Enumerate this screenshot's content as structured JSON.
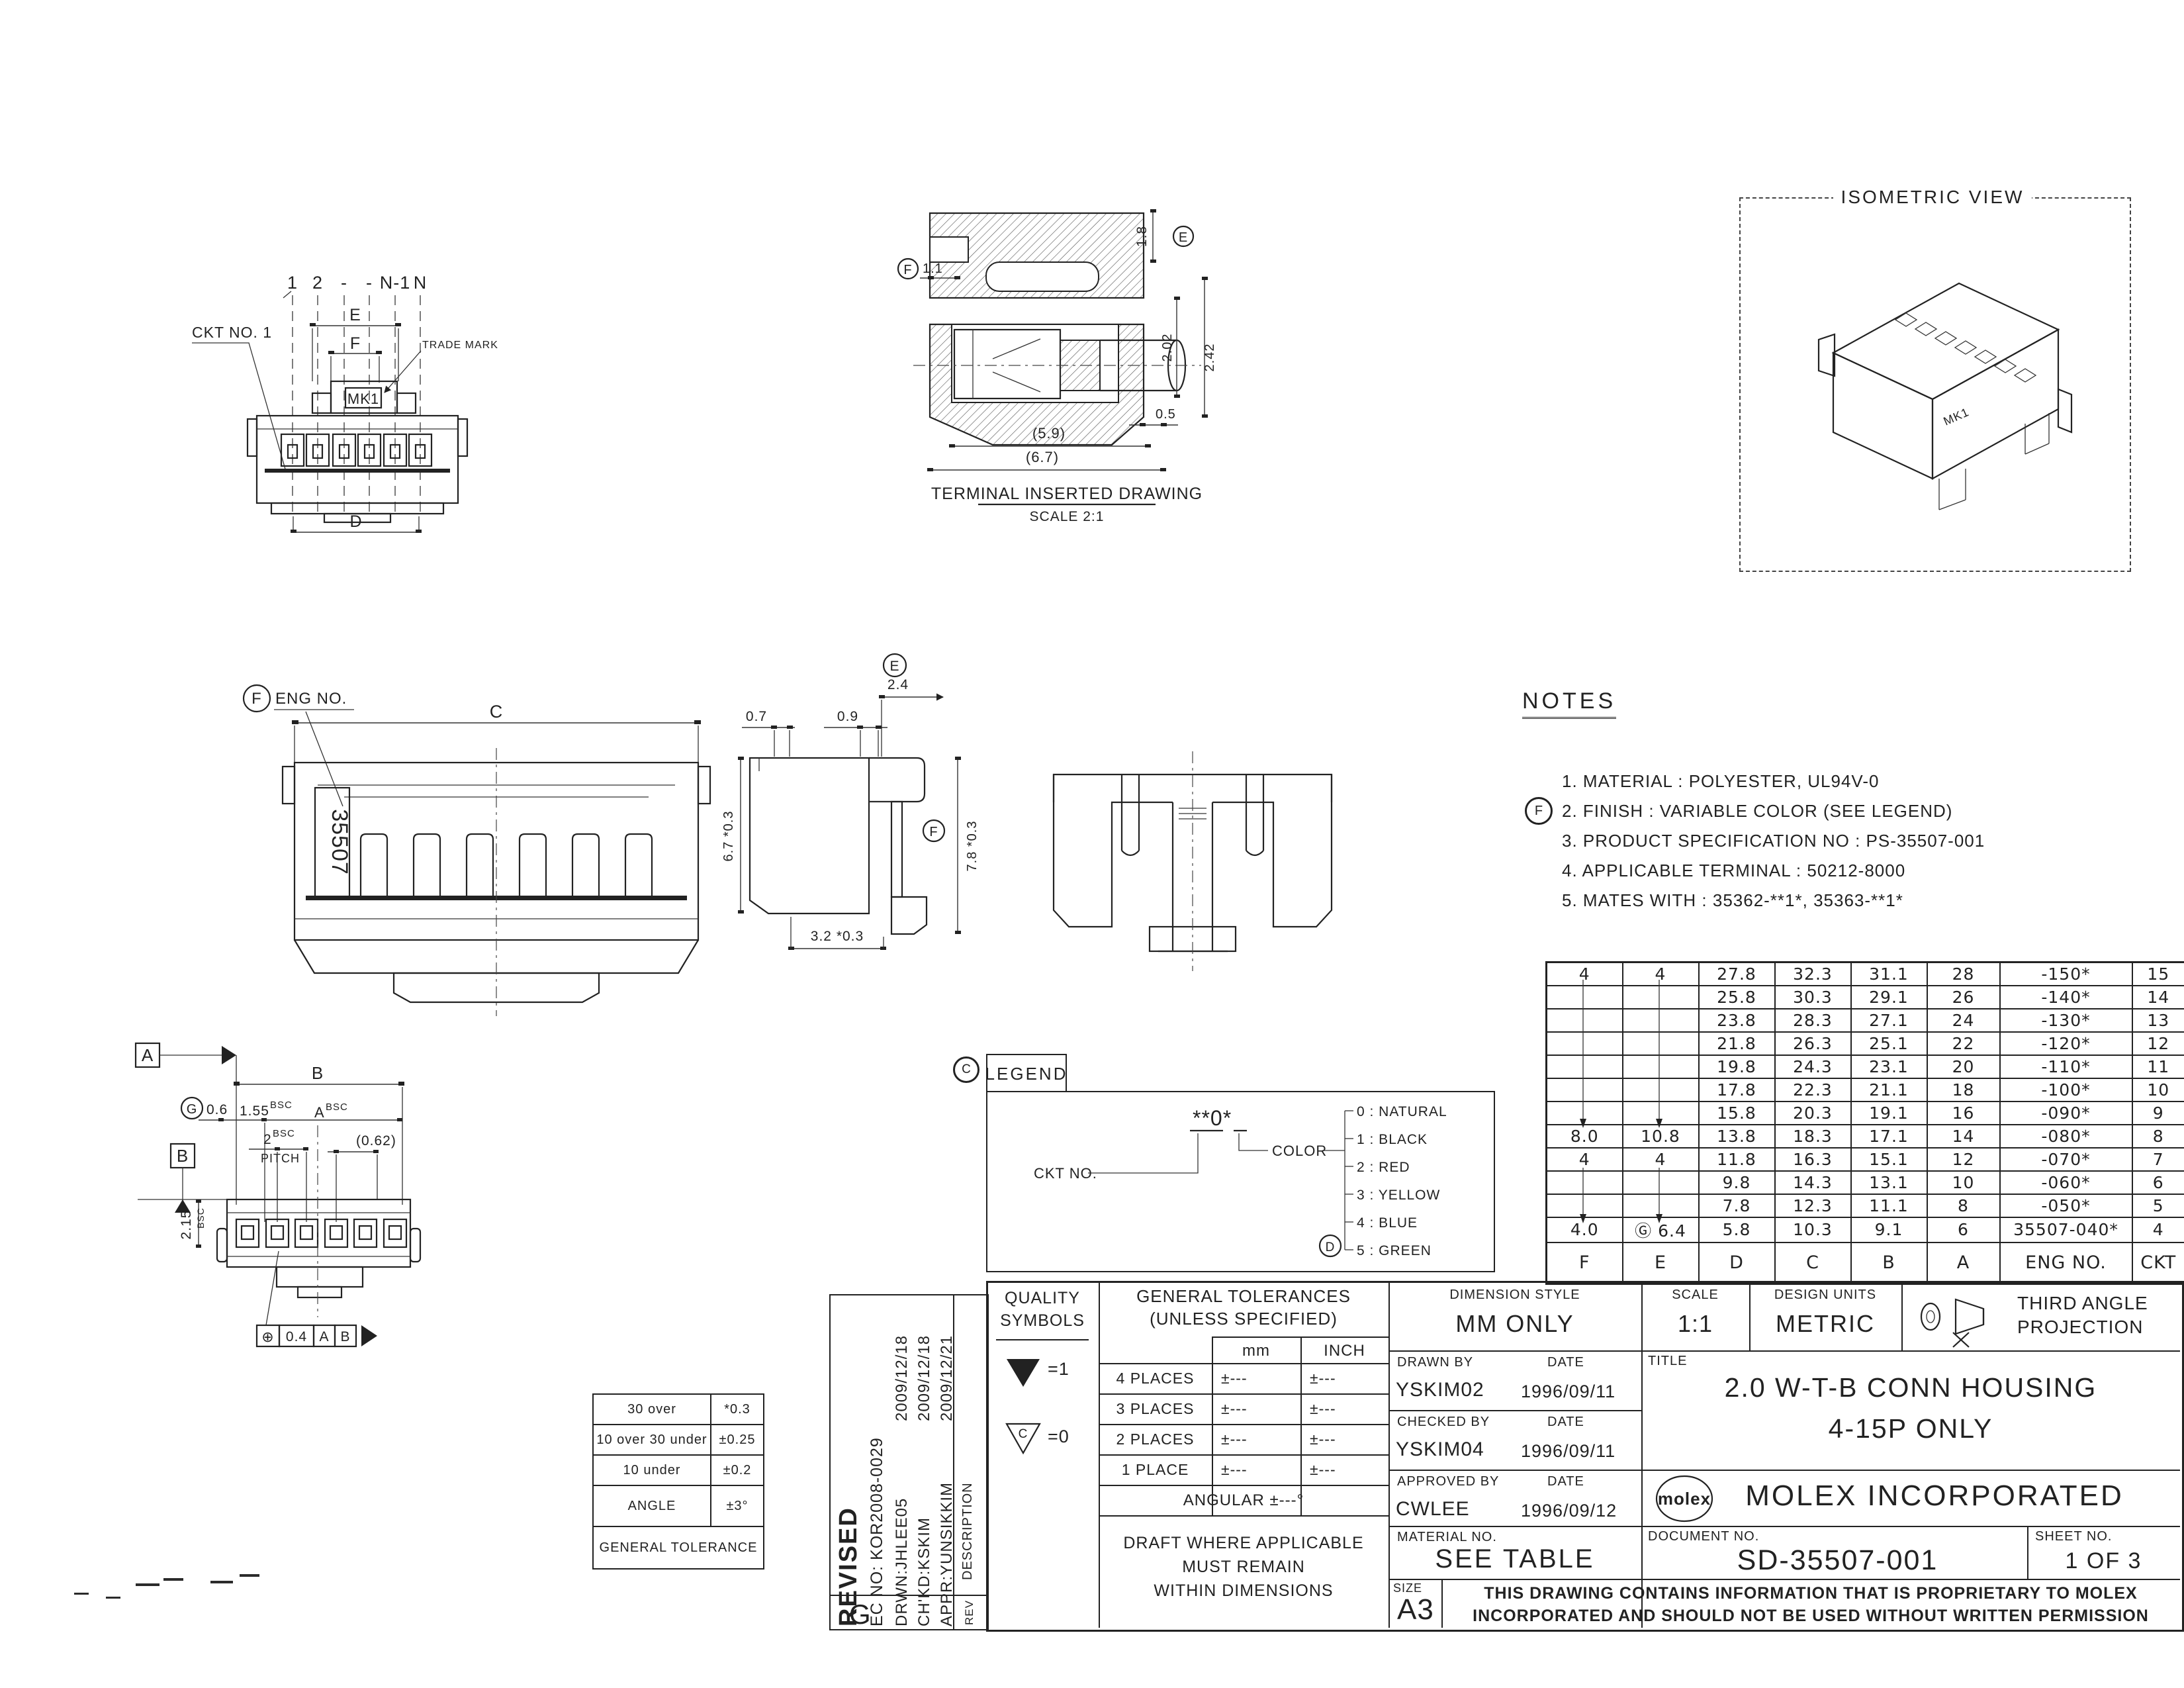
{
  "front_view": {
    "ckt_no": "CKT NO. 1",
    "circuit_labels": [
      "1",
      "2",
      "-",
      "-",
      "N-1",
      "N"
    ],
    "dim_e": "E",
    "dim_f": "F",
    "dim_d": "D",
    "trade_mark": "TRADE MARK",
    "mk1": "MK1"
  },
  "terminal_view": {
    "dim_18": "1.8",
    "dim_11": "1.1",
    "dim_202": "2.02",
    "dim_242": "2.42",
    "dim_05": "0.5",
    "dim_59": "(5.9)",
    "dim_67": "(6.7)",
    "balloon_e": "E",
    "balloon_f": "F",
    "caption": "TERMINAL INSERTED DRAWING",
    "scale": "SCALE 2:1"
  },
  "iso_view": {
    "title": "ISOMETRIC VIEW",
    "mk1": "MK1"
  },
  "rear_view": {
    "balloon_f": "F",
    "eng_no": "ENG NO.",
    "dim_c": "C",
    "part_no": "35507"
  },
  "side_view": {
    "balloon_e": "E",
    "balloon_f": "F",
    "dim_24": "2.4",
    "dim_07": "0.7",
    "dim_09": "0.9",
    "dim_67": "6.7 *0.3",
    "dim_78": "7.8 *0.3",
    "dim_32": "3.2 *0.3"
  },
  "bottom_view": {
    "datum_a": "A",
    "datum_b": "B",
    "balloon_g": "G",
    "dim_06": "0.6",
    "dim_155": "1.55",
    "bsc1": "BSC",
    "dim_a": "A",
    "bsc2": "BSC",
    "dim_2": "2",
    "bsc3": "BSC",
    "pitch": "PITCH",
    "dim_062": "(0.62)",
    "dim_b": "B",
    "dim_215": "2.15",
    "bsc4": "BSC",
    "fcf_sym": "⊕",
    "fcf_tol": "0.4",
    "fcf_a": "A",
    "fcf_b": "B"
  },
  "notes": {
    "title": "NOTES",
    "balloon_f": "F",
    "items": [
      "1. MATERIAL : POLYESTER, UL94V-0",
      "2. FINISH : VARIABLE COLOR (SEE LEGEND)",
      "3. PRODUCT SPECIFICATION NO : PS-35507-001",
      "4. APPLICABLE TERMINAL : 50212-8000",
      "5. MATES WITH : 35362-**1*, 35363-**1*"
    ]
  },
  "legend": {
    "balloon_c": "C",
    "title": "LEGEND",
    "pattern": "**0*",
    "ckt_no": "CKT NO.",
    "color": "COLOR",
    "balloon_d": "D",
    "colors": [
      "0 : NATURAL",
      "1 : BLACK",
      "2 : RED",
      "3 : YELLOW",
      "4 : BLUE",
      "5 : GREEN"
    ]
  },
  "spec_table": {
    "headers": [
      "F",
      "E",
      "D",
      "C",
      "B",
      "A",
      "ENG NO.",
      "CKT"
    ],
    "rows": [
      [
        "4",
        "4",
        "27.8",
        "32.3",
        "31.1",
        "28",
        "-150*",
        "15"
      ],
      [
        "",
        "",
        "25.8",
        "30.3",
        "29.1",
        "26",
        "-140*",
        "14"
      ],
      [
        "",
        "",
        "23.8",
        "28.3",
        "27.1",
        "24",
        "-130*",
        "13"
      ],
      [
        "",
        "",
        "21.8",
        "26.3",
        "25.1",
        "22",
        "-120*",
        "12"
      ],
      [
        "",
        "",
        "19.8",
        "24.3",
        "23.1",
        "20",
        "-110*",
        "11"
      ],
      [
        "",
        "",
        "17.8",
        "22.3",
        "21.1",
        "18",
        "-100*",
        "10"
      ],
      [
        "",
        "",
        "15.8",
        "20.3",
        "19.1",
        "16",
        "-090*",
        "9"
      ],
      [
        "8.0",
        "10.8",
        "13.8",
        "18.3",
        "17.1",
        "14",
        "-080*",
        "8"
      ],
      [
        "4",
        "4",
        "11.8",
        "16.3",
        "15.1",
        "12",
        "-070*",
        "7"
      ],
      [
        "",
        "",
        "9.8",
        "14.3",
        "13.1",
        "10",
        "-060*",
        "6"
      ],
      [
        "",
        "",
        "7.8",
        "12.3",
        "11.1",
        "8",
        "-050*",
        "5"
      ],
      [
        "4.0",
        "Ⓖ 6.4",
        "5.8",
        "10.3",
        "9.1",
        "6",
        "35507-040*",
        "4"
      ]
    ]
  },
  "quality": {
    "line1": "QUALITY",
    "line2": "SYMBOLS",
    "v1": "=1",
    "v0": "=0",
    "c": "C"
  },
  "gen_tol": {
    "title1": "GENERAL TOLERANCES",
    "title2": "(UNLESS SPECIFIED)",
    "col_mm": "mm",
    "col_inch": "INCH",
    "rows": [
      [
        "4 PLACES",
        "±---",
        "±---"
      ],
      [
        "3 PLACES",
        "±---",
        "±---"
      ],
      [
        "2 PLACES",
        "±---",
        "±---"
      ],
      [
        "1 PLACE",
        "±---",
        "±---"
      ]
    ],
    "angular": "ANGULAR ±---°",
    "draft1": "DRAFT WHERE APPLICABLE",
    "draft2": "MUST REMAIN",
    "draft3": "WITHIN DIMENSIONS"
  },
  "tol_table": {
    "rows": [
      [
        "30 over",
        "*0.3"
      ],
      [
        "10 over 30 under",
        "±0.25"
      ],
      [
        "10 under",
        "±0.2"
      ],
      [
        "ANGLE",
        "±3°"
      ]
    ],
    "footer": "GENERAL TOLERANCE"
  },
  "revised": {
    "title": "REVISED",
    "ec": "EC NO: KOR2008-0029",
    "drwn": "DRWN:JHLEE05",
    "chkd": "CH'KD:KSKIM",
    "appr": "APPR:YUNSIKKIM",
    "date1": "2009/12/18",
    "date2": "2009/12/18",
    "date3": "2009/12/21",
    "description": "DESCRIPTION",
    "rev_letter": "G",
    "rev": "REV"
  },
  "titleblock": {
    "dim_style_label": "DIMENSION STYLE",
    "dim_style": "MM ONLY",
    "scale_label": "SCALE",
    "scale": "1:1",
    "units_label": "DESIGN UNITS",
    "units": "METRIC",
    "proj1": "THIRD ANGLE",
    "proj2": "PROJECTION",
    "drawn_label": "DRAWN BY",
    "date_label1": "DATE",
    "drawn": "YSKIM02",
    "drawn_date": "1996/09/11",
    "checked_label": "CHECKED BY",
    "date_label2": "DATE",
    "checked": "YSKIM04",
    "checked_date": "1996/09/11",
    "approved_label": "APPROVED BY",
    "date_label3": "DATE",
    "approved": "CWLEE",
    "approved_date": "1996/09/12",
    "title_label": "TITLE",
    "title1": "2.0 W-T-B CONN HOUSING",
    "title2": "4-15P ONLY",
    "logo": "molex",
    "company": "MOLEX INCORPORATED",
    "material_label": "MATERIAL NO.",
    "material": "SEE TABLE",
    "doc_label": "DOCUMENT NO.",
    "doc_no": "SD-35507-001",
    "sheet_label": "SHEET NO.",
    "sheet": "1 OF 3",
    "size_label": "SIZE",
    "size": "A3",
    "prop1": "THIS DRAWING CONTAINS INFORMATION THAT IS PROPRIETARY TO MOLEX",
    "prop2": "INCORPORATED AND SHOULD NOT BE USED WITHOUT WRITTEN PERMISSION"
  }
}
